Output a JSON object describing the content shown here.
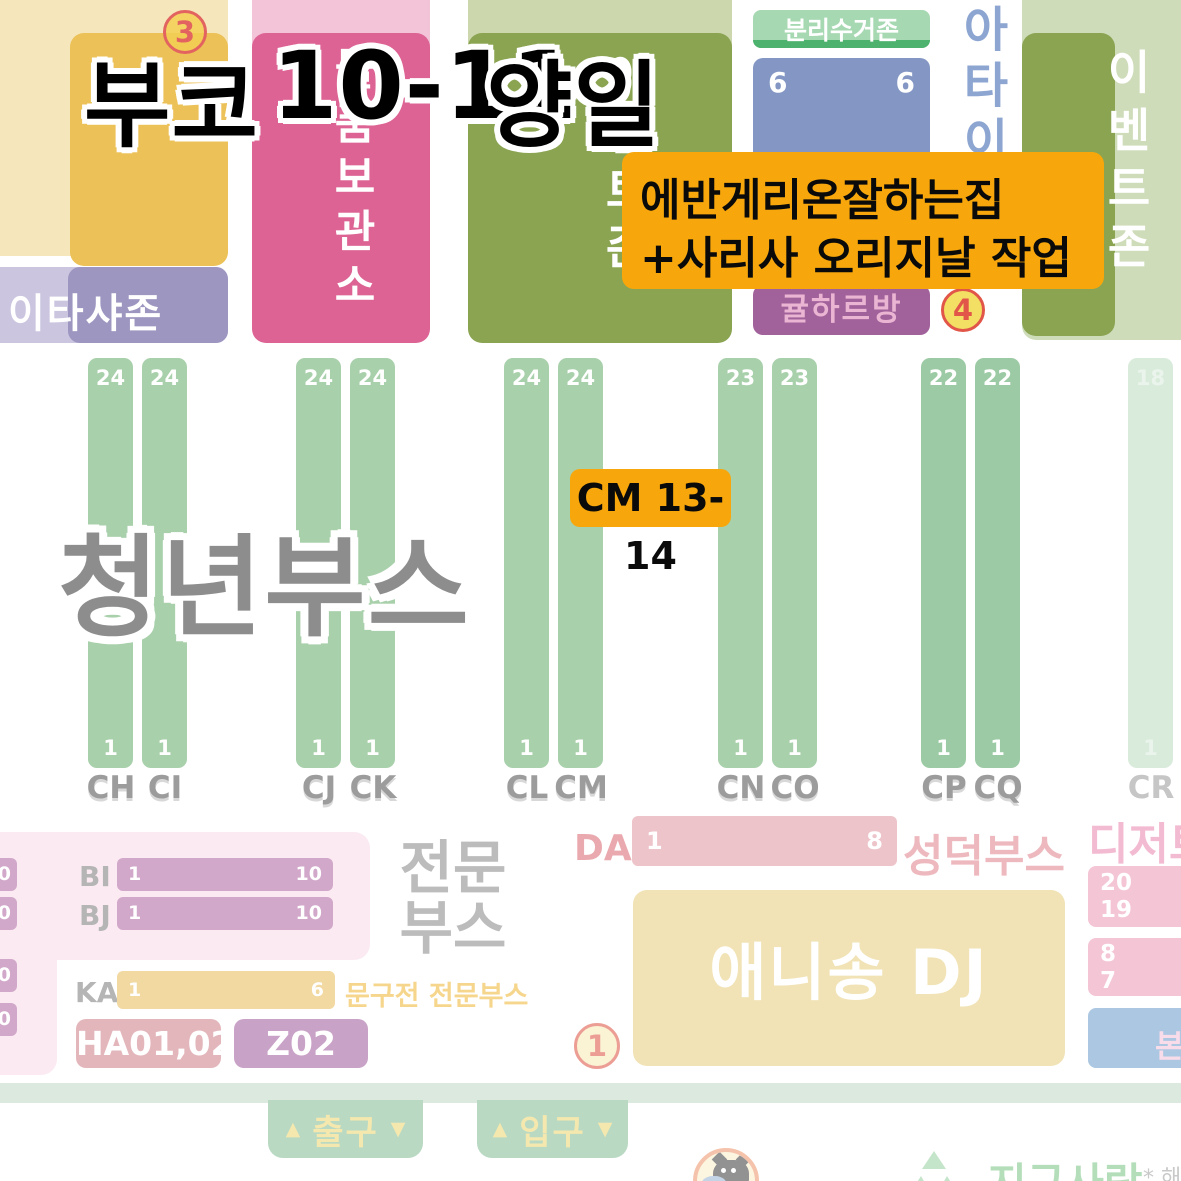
{
  "title": {
    "venue": "부코",
    "dates": "10-11",
    "days": "양일"
  },
  "badges": {
    "three": "3",
    "four": "4",
    "one": "1"
  },
  "zones": {
    "itasha": "이타샤존",
    "storage": "물품보관소",
    "event_mid": "이벤트존",
    "event_right": "이벤트존",
    "recycling": "분리수거존",
    "rec_left": "6",
    "rec_right": "6",
    "gyul": "귤하르방",
    "atai": "아타이",
    "youth": "청년부스",
    "pro_line1": "전문",
    "pro_line2": "부스",
    "stationery": "문구전 전문부스",
    "seongdeok": "성덕부스",
    "anisong": "애니송 DJ",
    "dessert": "디저트",
    "hq": "본부"
  },
  "callout": {
    "line1": "에반게리온잘하는집",
    "line2": "+사리사 오리지날 작업"
  },
  "cm_badge": {
    "label": "CM 13-14"
  },
  "columns": [
    {
      "label": "CH",
      "top": "24",
      "bottom": "1"
    },
    {
      "label": "CI",
      "top": "24",
      "bottom": "1"
    },
    {
      "label": "CJ",
      "top": "24",
      "bottom": "1"
    },
    {
      "label": "CK",
      "top": "24",
      "bottom": "1"
    },
    {
      "label": "CL",
      "top": "24",
      "bottom": "1"
    },
    {
      "label": "CM",
      "top": "24",
      "bottom": "1"
    },
    {
      "label": "CN",
      "top": "23",
      "bottom": "1"
    },
    {
      "label": "CO",
      "top": "23",
      "bottom": "1"
    },
    {
      "label": "CP",
      "top": "22",
      "bottom": "1"
    },
    {
      "label": "CQ",
      "top": "22",
      "bottom": "1"
    },
    {
      "label": "CR",
      "top": "18",
      "bottom": "1"
    }
  ],
  "left_rows": {
    "edge": [
      "0",
      "0",
      "0",
      "0"
    ],
    "bi": {
      "label": "BI",
      "start": "1",
      "end": "10"
    },
    "bj": {
      "label": "BJ",
      "start": "1",
      "end": "10"
    },
    "ka": {
      "label": "KA",
      "start": "1",
      "end": "6"
    },
    "ha_label": "HA01,02",
    "z_label": "Z02"
  },
  "da_row": {
    "label": "DA",
    "start": "1",
    "end": "8"
  },
  "right_col": {
    "block1": [
      "20",
      "19"
    ],
    "block2": [
      "8",
      "7"
    ]
  },
  "footer": {
    "up": "▲",
    "down": "▼",
    "exit": "출구",
    "entrance": "입구",
    "earth_love": "지구사랑",
    "note": "* 해당"
  }
}
